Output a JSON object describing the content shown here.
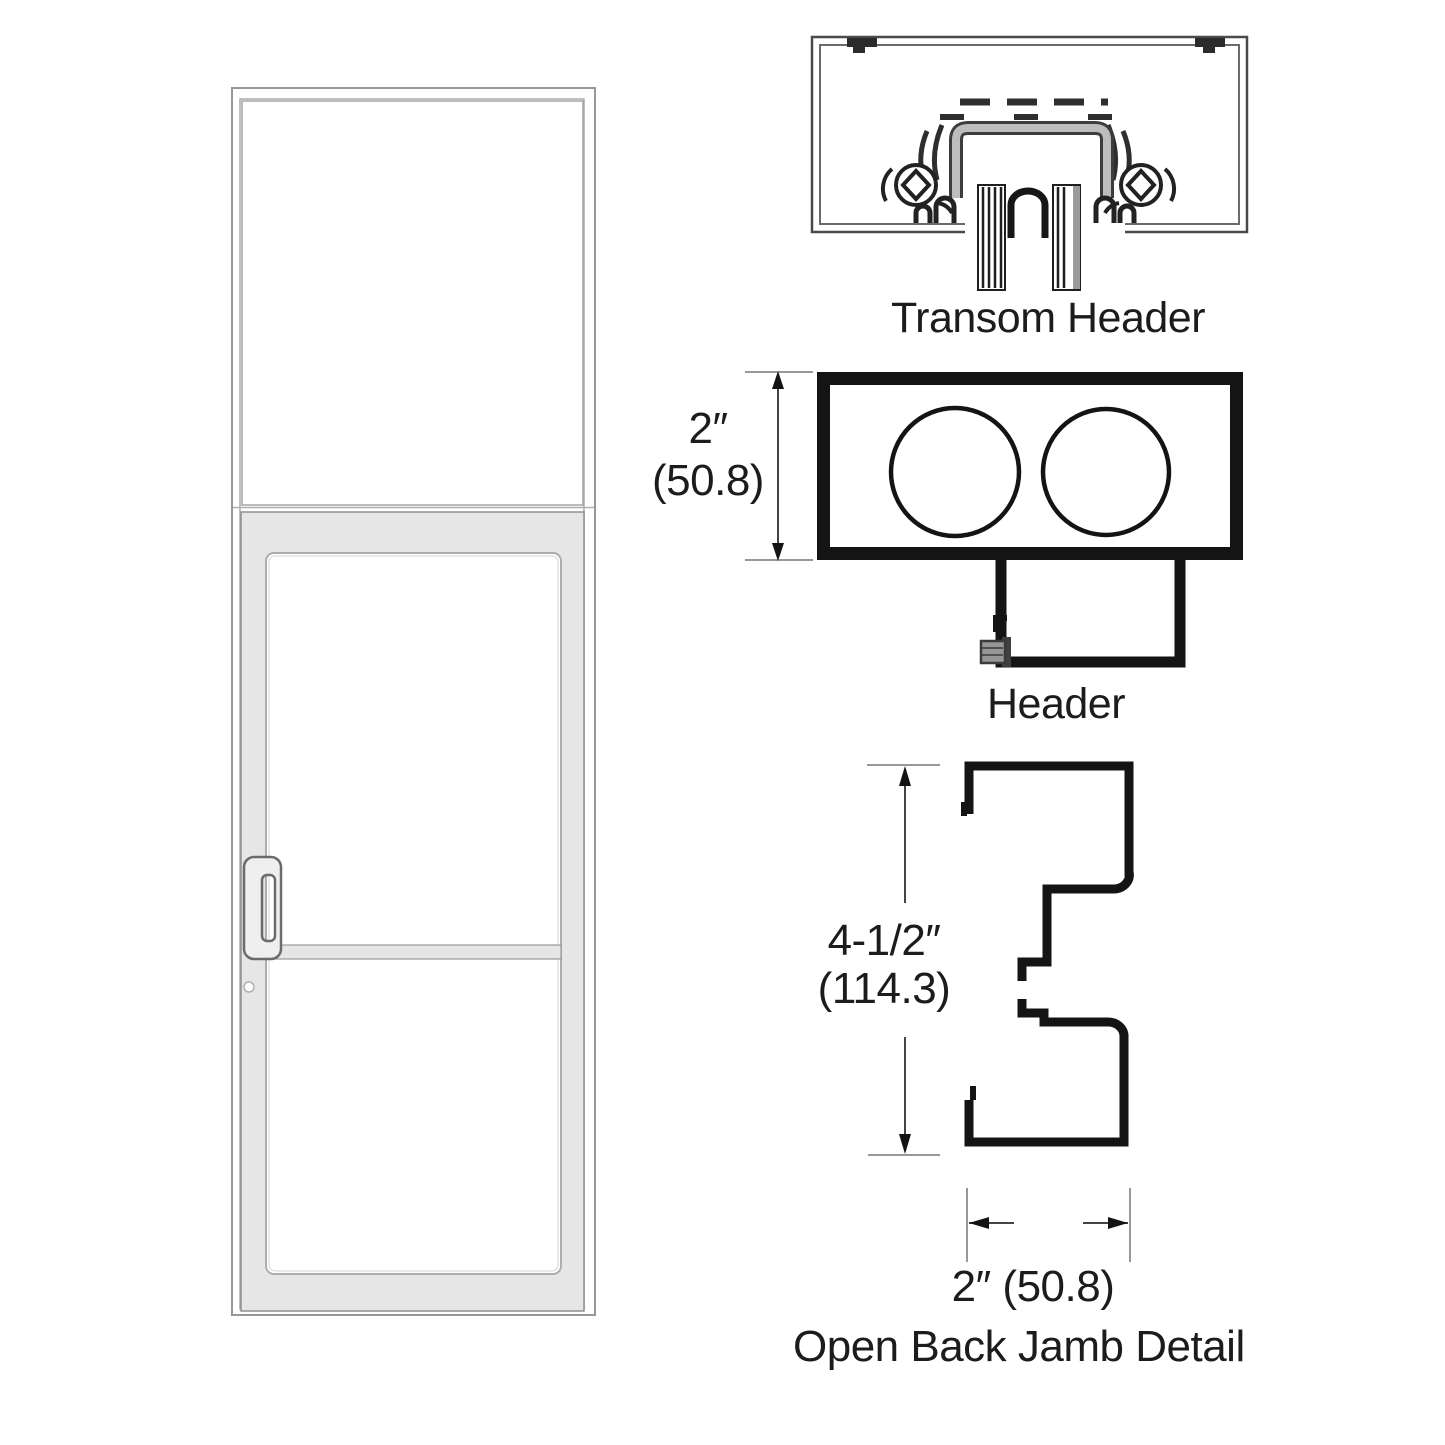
{
  "labels": {
    "transom_header": "Transom Header",
    "header": "Header",
    "open_back_jamb": "Open Back Jamb Detail"
  },
  "dimensions": {
    "header_height_in": "2″",
    "header_height_mm": "(50.8)",
    "jamb_height_in": "4-1/2″",
    "jamb_height_mm": "(114.3)",
    "jamb_width": "2″ (50.8)"
  },
  "colors": {
    "background": "#ffffff",
    "drawing_line": "#161616",
    "thin_dim_line": "#999999",
    "dim_shaft": "#444444",
    "aluminum_fill": "#e6e6e6",
    "frame_outline": "#979797",
    "text": "#1c1c1c"
  }
}
